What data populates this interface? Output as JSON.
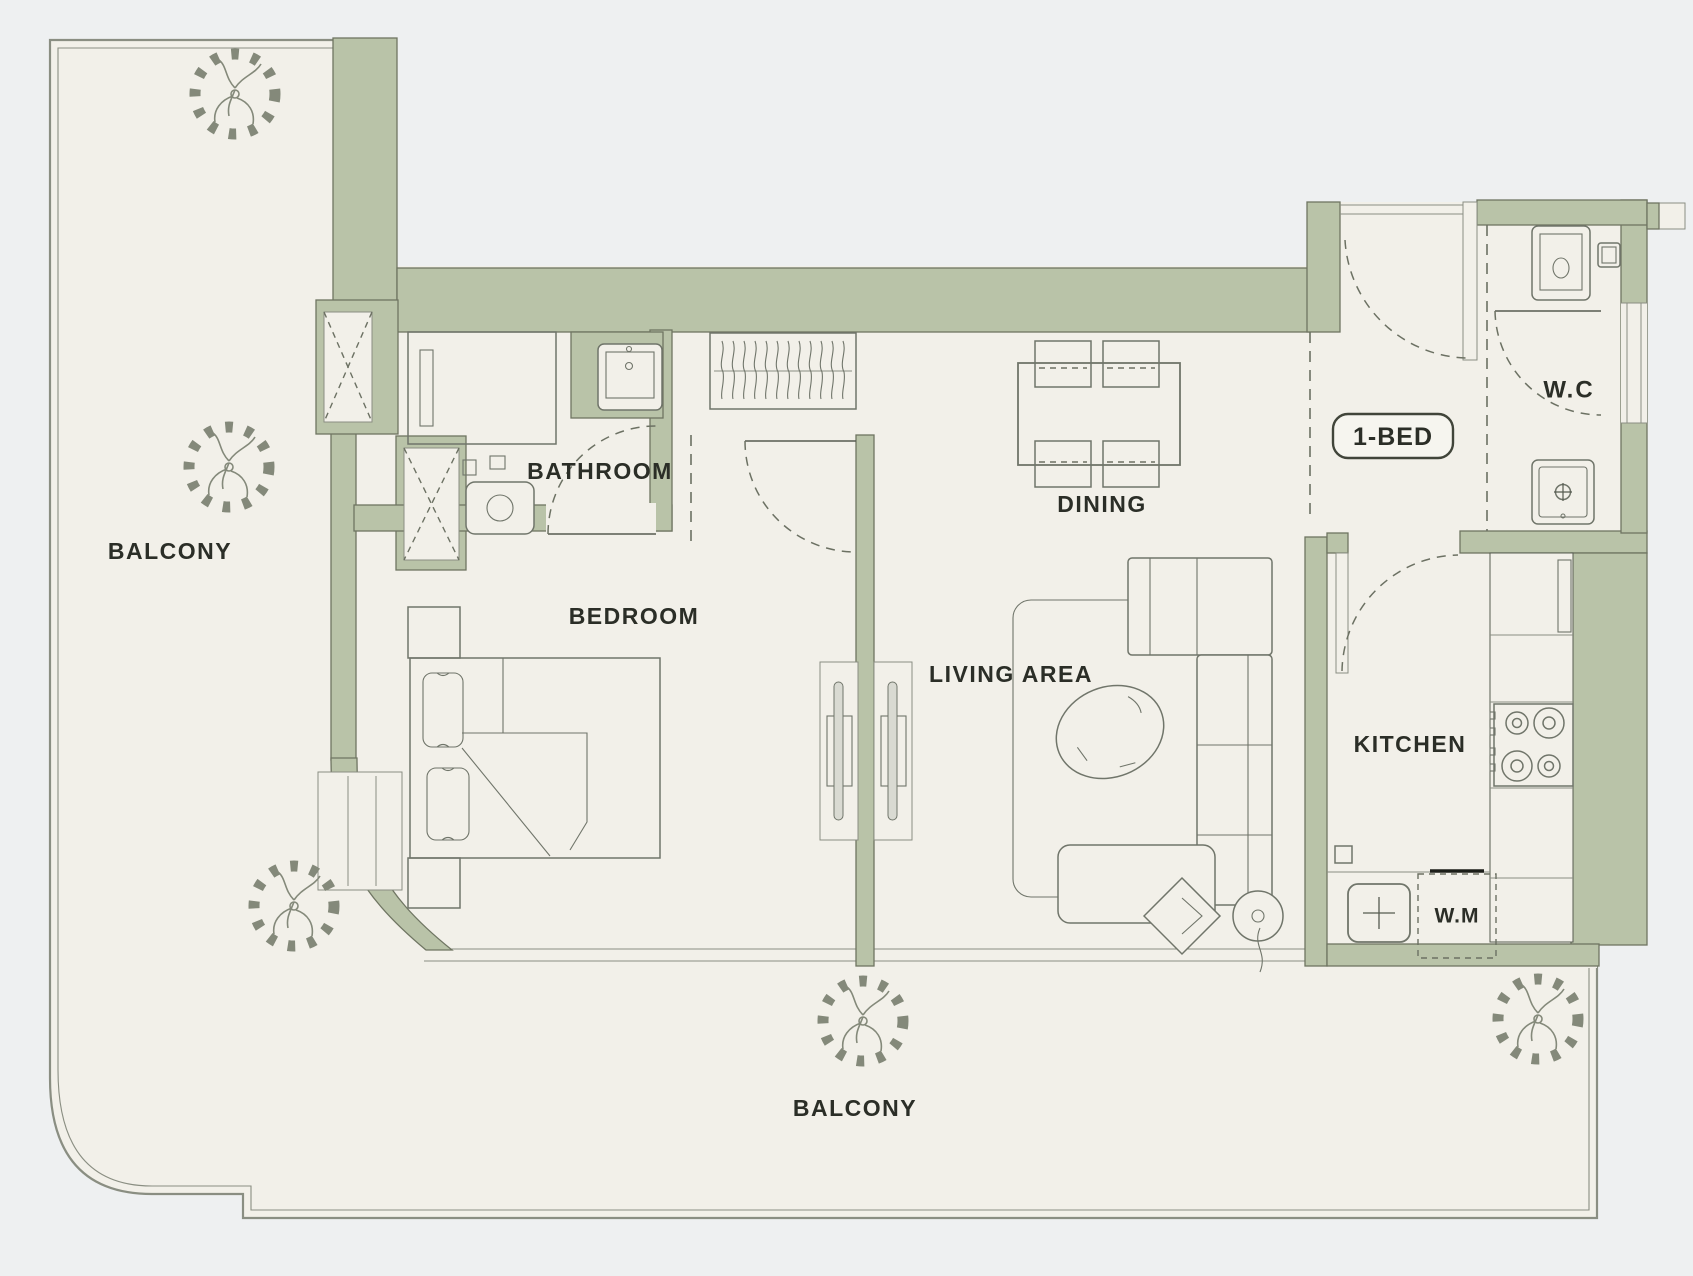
{
  "plan": {
    "type": "apartment-floor-plan",
    "unit_badge": "1-BED",
    "rooms": {
      "balcony_left": {
        "label": "BALCONY"
      },
      "balcony_bottom": {
        "label": "BALCONY"
      },
      "bathroom": {
        "label": "BATHROOM"
      },
      "bedroom": {
        "label": "BEDROOM"
      },
      "dining": {
        "label": "DINING"
      },
      "living": {
        "label": "LIVING AREA"
      },
      "kitchen": {
        "label": "KITCHEN"
      },
      "wc": {
        "label": "W.C"
      }
    },
    "appliances": {
      "washing_machine": {
        "label": "W.M"
      }
    },
    "fixtures": [
      "shower",
      "bathroom-sink",
      "toilet",
      "wardrobe-hangers",
      "double-bed",
      "nightstand",
      "dining-table",
      "dining-chairs",
      "rug",
      "coffee-table",
      "sofa",
      "ottoman",
      "lounge-chair",
      "floor-lamp",
      "stove-4-burner",
      "kitchen-sink",
      "washing-machine",
      "wc-sink",
      "wc-toilet",
      "service-shaft"
    ],
    "tree_symbols": 5,
    "door_swings": 5
  },
  "colors": {
    "background": "#eef0f1",
    "floor": "#f2f0e9",
    "wall": "#b9c3a8",
    "wall_stroke": "#6f7562",
    "line": "#565b50",
    "line2": "#8a8e82",
    "furniture": "#70756a",
    "dash": "#6c7163",
    "tree": "#84897a",
    "text": "#2b2e27",
    "badge_fill": "#f6f5ef",
    "badge_stroke": "#41453a",
    "panel": "#d9dad2",
    "black": "#1c1e19"
  }
}
